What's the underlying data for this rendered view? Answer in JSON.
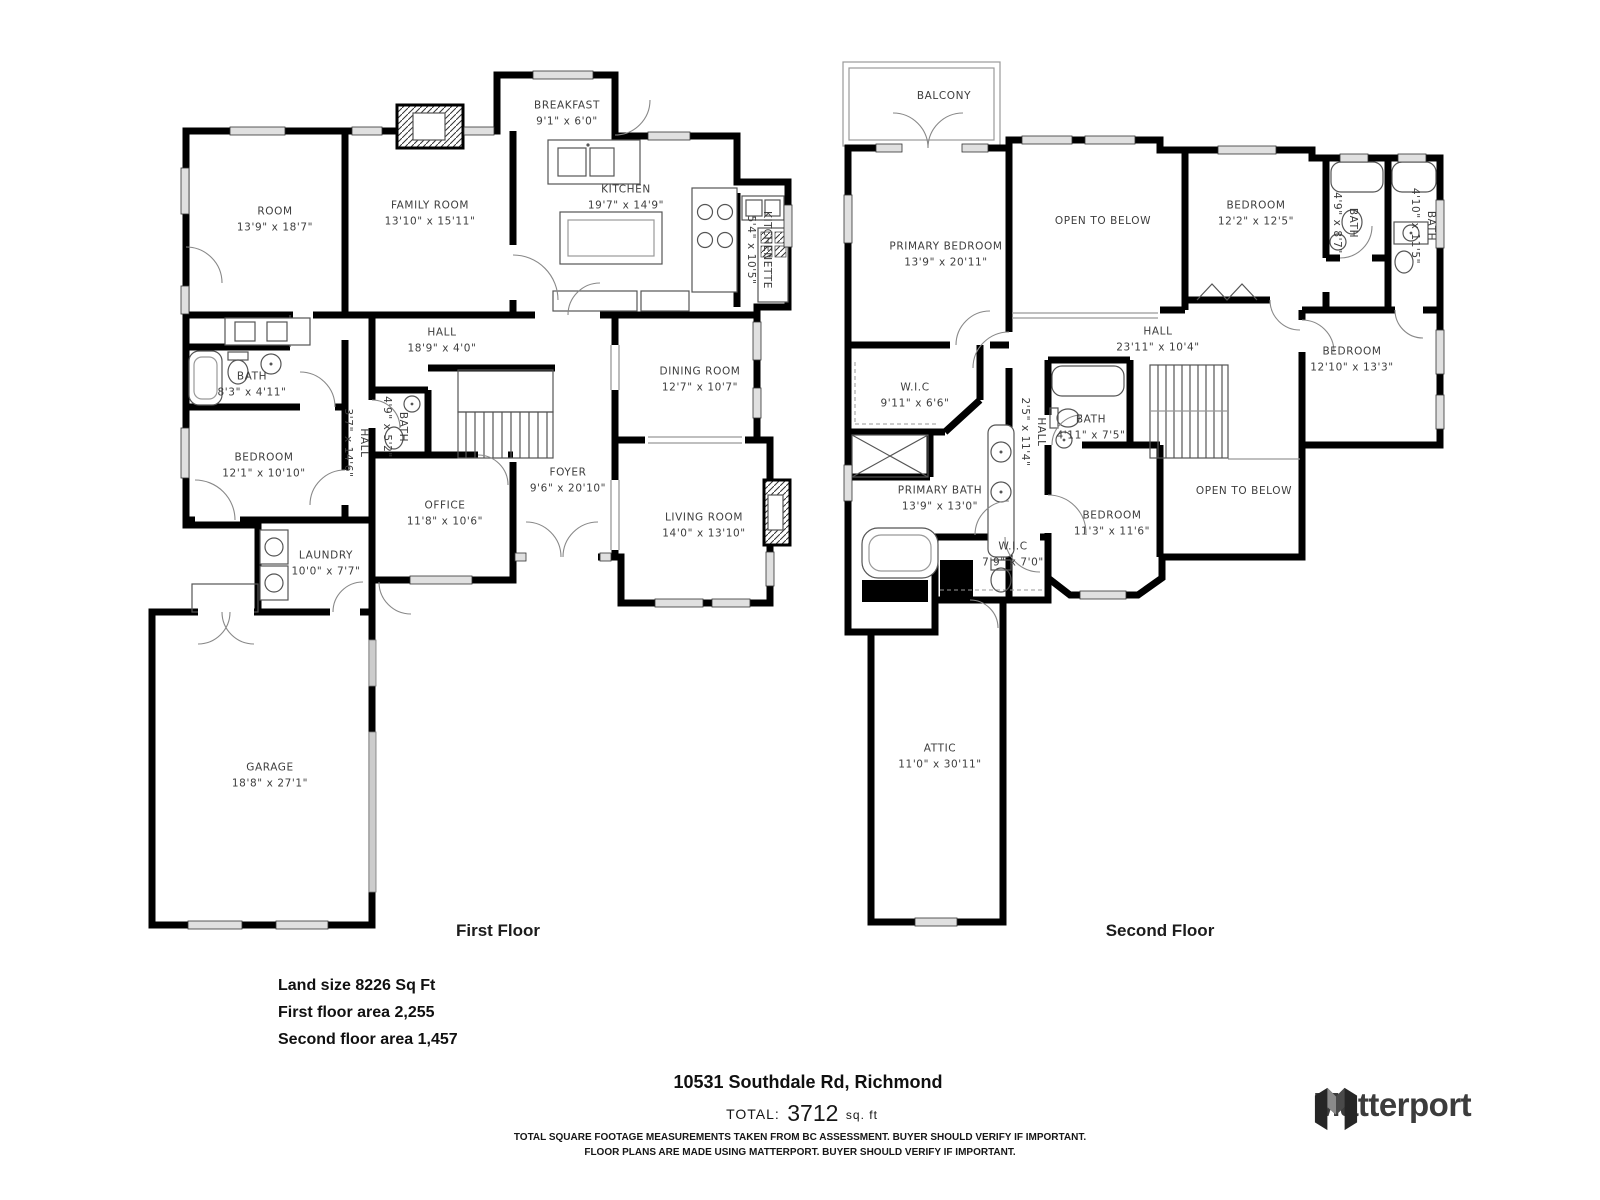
{
  "page": {
    "address": "10531 Southdale Rd, Richmond",
    "total_label": "TOTAL:",
    "total_value": "3712",
    "total_unit": "sq. ft",
    "stats": {
      "land": "Land size 8226 Sq Ft",
      "first": "First floor area 2,255",
      "second": "Second floor area 1,457"
    },
    "disclaimer_line1": "TOTAL SQUARE FOOTAGE MEASUREMENTS TAKEN FROM BC ASSESSMENT. BUYER SHOULD VERIFY IF IMPORTANT.",
    "disclaimer_line2": "FLOOR PLANS ARE MADE USING MATTERPORT. BUYER SHOULD VERIFY IF IMPORTANT.",
    "brand": "Matterport"
  },
  "floors": [
    {
      "title": "First Floor",
      "rooms": [
        {
          "n": "ROOM",
          "d": "13'9\" x 18'7\"",
          "x": 275,
          "y": 220
        },
        {
          "n": "FAMILY ROOM",
          "d": "13'10\" x 15'11\"",
          "x": 430,
          "y": 214
        },
        {
          "n": "BREAKFAST",
          "d": "9'1\" x 6'0\"",
          "x": 567,
          "y": 114
        },
        {
          "n": "KITCHEN",
          "d": "19'7\" x 14'9\"",
          "x": 626,
          "y": 198
        },
        {
          "n": "KITCHENETTE",
          "d": "5'4\" x 10'5\"",
          "x": 758,
          "y": 250,
          "r": 90
        },
        {
          "n": "HALL",
          "d": "18'9\" x 4'0\"",
          "x": 442,
          "y": 341
        },
        {
          "n": "BATH",
          "d": "8'3\" x 4'11\"",
          "x": 252,
          "y": 385
        },
        {
          "n": "HALL",
          "d": "3'7\" x 14'6\"",
          "x": 355,
          "y": 443,
          "r": 90
        },
        {
          "n": "BATH",
          "d": "4'9\" x 5'2\"",
          "x": 394,
          "y": 427,
          "r": 90
        },
        {
          "n": "BEDROOM",
          "d": "12'1\" x 10'10\"",
          "x": 264,
          "y": 466
        },
        {
          "n": "OFFICE",
          "d": "11'8\" x 10'6\"",
          "x": 445,
          "y": 514
        },
        {
          "n": "FOYER",
          "d": "9'6\" x 20'10\"",
          "x": 568,
          "y": 481
        },
        {
          "n": "DINING ROOM",
          "d": "12'7\" x 10'7\"",
          "x": 700,
          "y": 380
        },
        {
          "n": "LIVING ROOM",
          "d": "14'0\" x 13'10\"",
          "x": 704,
          "y": 526
        },
        {
          "n": "LAUNDRY",
          "d": "10'0\" x 7'7\"",
          "x": 326,
          "y": 564
        },
        {
          "n": "GARAGE",
          "d": "18'8\" x 27'1\"",
          "x": 270,
          "y": 776
        }
      ]
    },
    {
      "title": "Second Floor",
      "rooms": [
        {
          "n": "BALCONY",
          "x": 944,
          "y": 97
        },
        {
          "n": "PRIMARY BEDROOM",
          "d": "13'9\" x 20'11\"",
          "x": 946,
          "y": 255
        },
        {
          "n": "OPEN TO BELOW",
          "x": 1103,
          "y": 222
        },
        {
          "n": "BEDROOM",
          "d": "12'2\" x 12'5\"",
          "x": 1256,
          "y": 214
        },
        {
          "n": "BATH",
          "d": "4'9\" x 8'7\"",
          "x": 1344,
          "y": 223,
          "r": 90
        },
        {
          "n": "BATH",
          "d": "4'10\" x 11'5\"",
          "x": 1422,
          "y": 226,
          "r": 90
        },
        {
          "n": "HALL",
          "d": "23'11\" x 10'4\"",
          "x": 1158,
          "y": 340
        },
        {
          "n": "BEDROOM",
          "d": "12'10\" x 13'3\"",
          "x": 1352,
          "y": 360
        },
        {
          "n": "W.I.C",
          "d": "9'11\" x 6'6\"",
          "x": 915,
          "y": 396
        },
        {
          "n": "HALL",
          "d": "2'5\" x 11'4\"",
          "x": 1032,
          "y": 432,
          "r": 90
        },
        {
          "n": "BATH",
          "d": "4'11\" x 7'5\"",
          "x": 1091,
          "y": 428
        },
        {
          "n": "PRIMARY BATH",
          "d": "13'9\" x 13'0\"",
          "x": 940,
          "y": 499
        },
        {
          "n": "BEDROOM",
          "d": "11'3\" x 11'6\"",
          "x": 1112,
          "y": 524
        },
        {
          "n": "W.I.C",
          "d": "7'9\" x 7'0\"",
          "x": 1013,
          "y": 555
        },
        {
          "n": "OPEN TO BELOW",
          "x": 1244,
          "y": 492
        },
        {
          "n": "ATTIC",
          "d": "11'0\" x 30'11\"",
          "x": 940,
          "y": 757
        }
      ]
    }
  ]
}
